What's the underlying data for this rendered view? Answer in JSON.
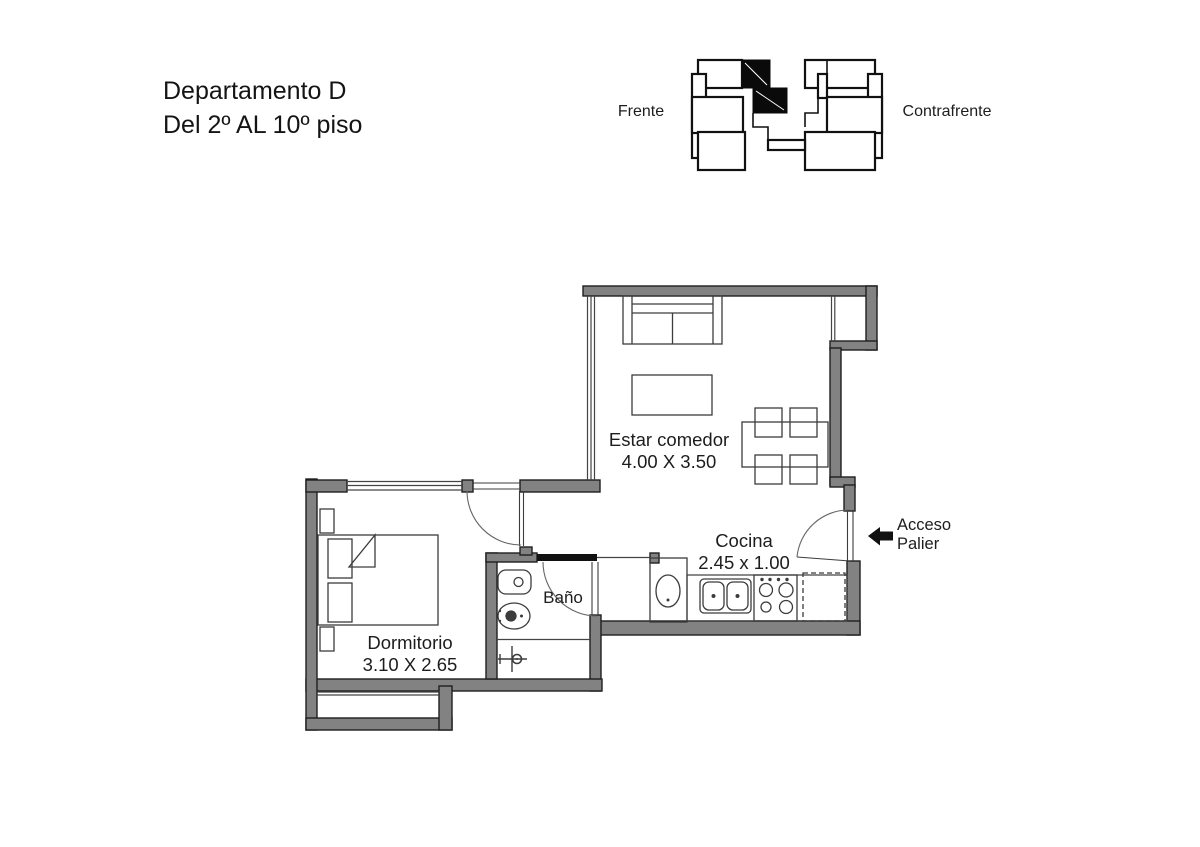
{
  "title": {
    "line1": "Departamento D",
    "line2": "Del 2º AL 10º piso"
  },
  "key_plan": {
    "front_label": "Frente",
    "back_label": "Contrafrente",
    "highlighted_unit": "Departamento D",
    "highlight_color": "#0a0a0a"
  },
  "rooms": {
    "living": {
      "name": "Estar comedor",
      "dims": "4.00 X 3.50"
    },
    "kitchen": {
      "name": "Cocina",
      "dims": "2.45 x 1.00"
    },
    "bathroom": {
      "name": "Baño"
    },
    "bedroom": {
      "name": "Dormitorio",
      "dims": "3.10 X 2.65"
    }
  },
  "access": {
    "line1": "Acceso",
    "line2": "Palier",
    "icon": "arrow-left-icon"
  },
  "colors": {
    "background": "#ffffff",
    "wall_fill": "#828282",
    "wall_stroke": "#1f1f1f",
    "fixture_line": "#3c3c3c",
    "door_arc": "#666666",
    "text": "#1d1d1d",
    "highlight": "#0a0a0a"
  }
}
